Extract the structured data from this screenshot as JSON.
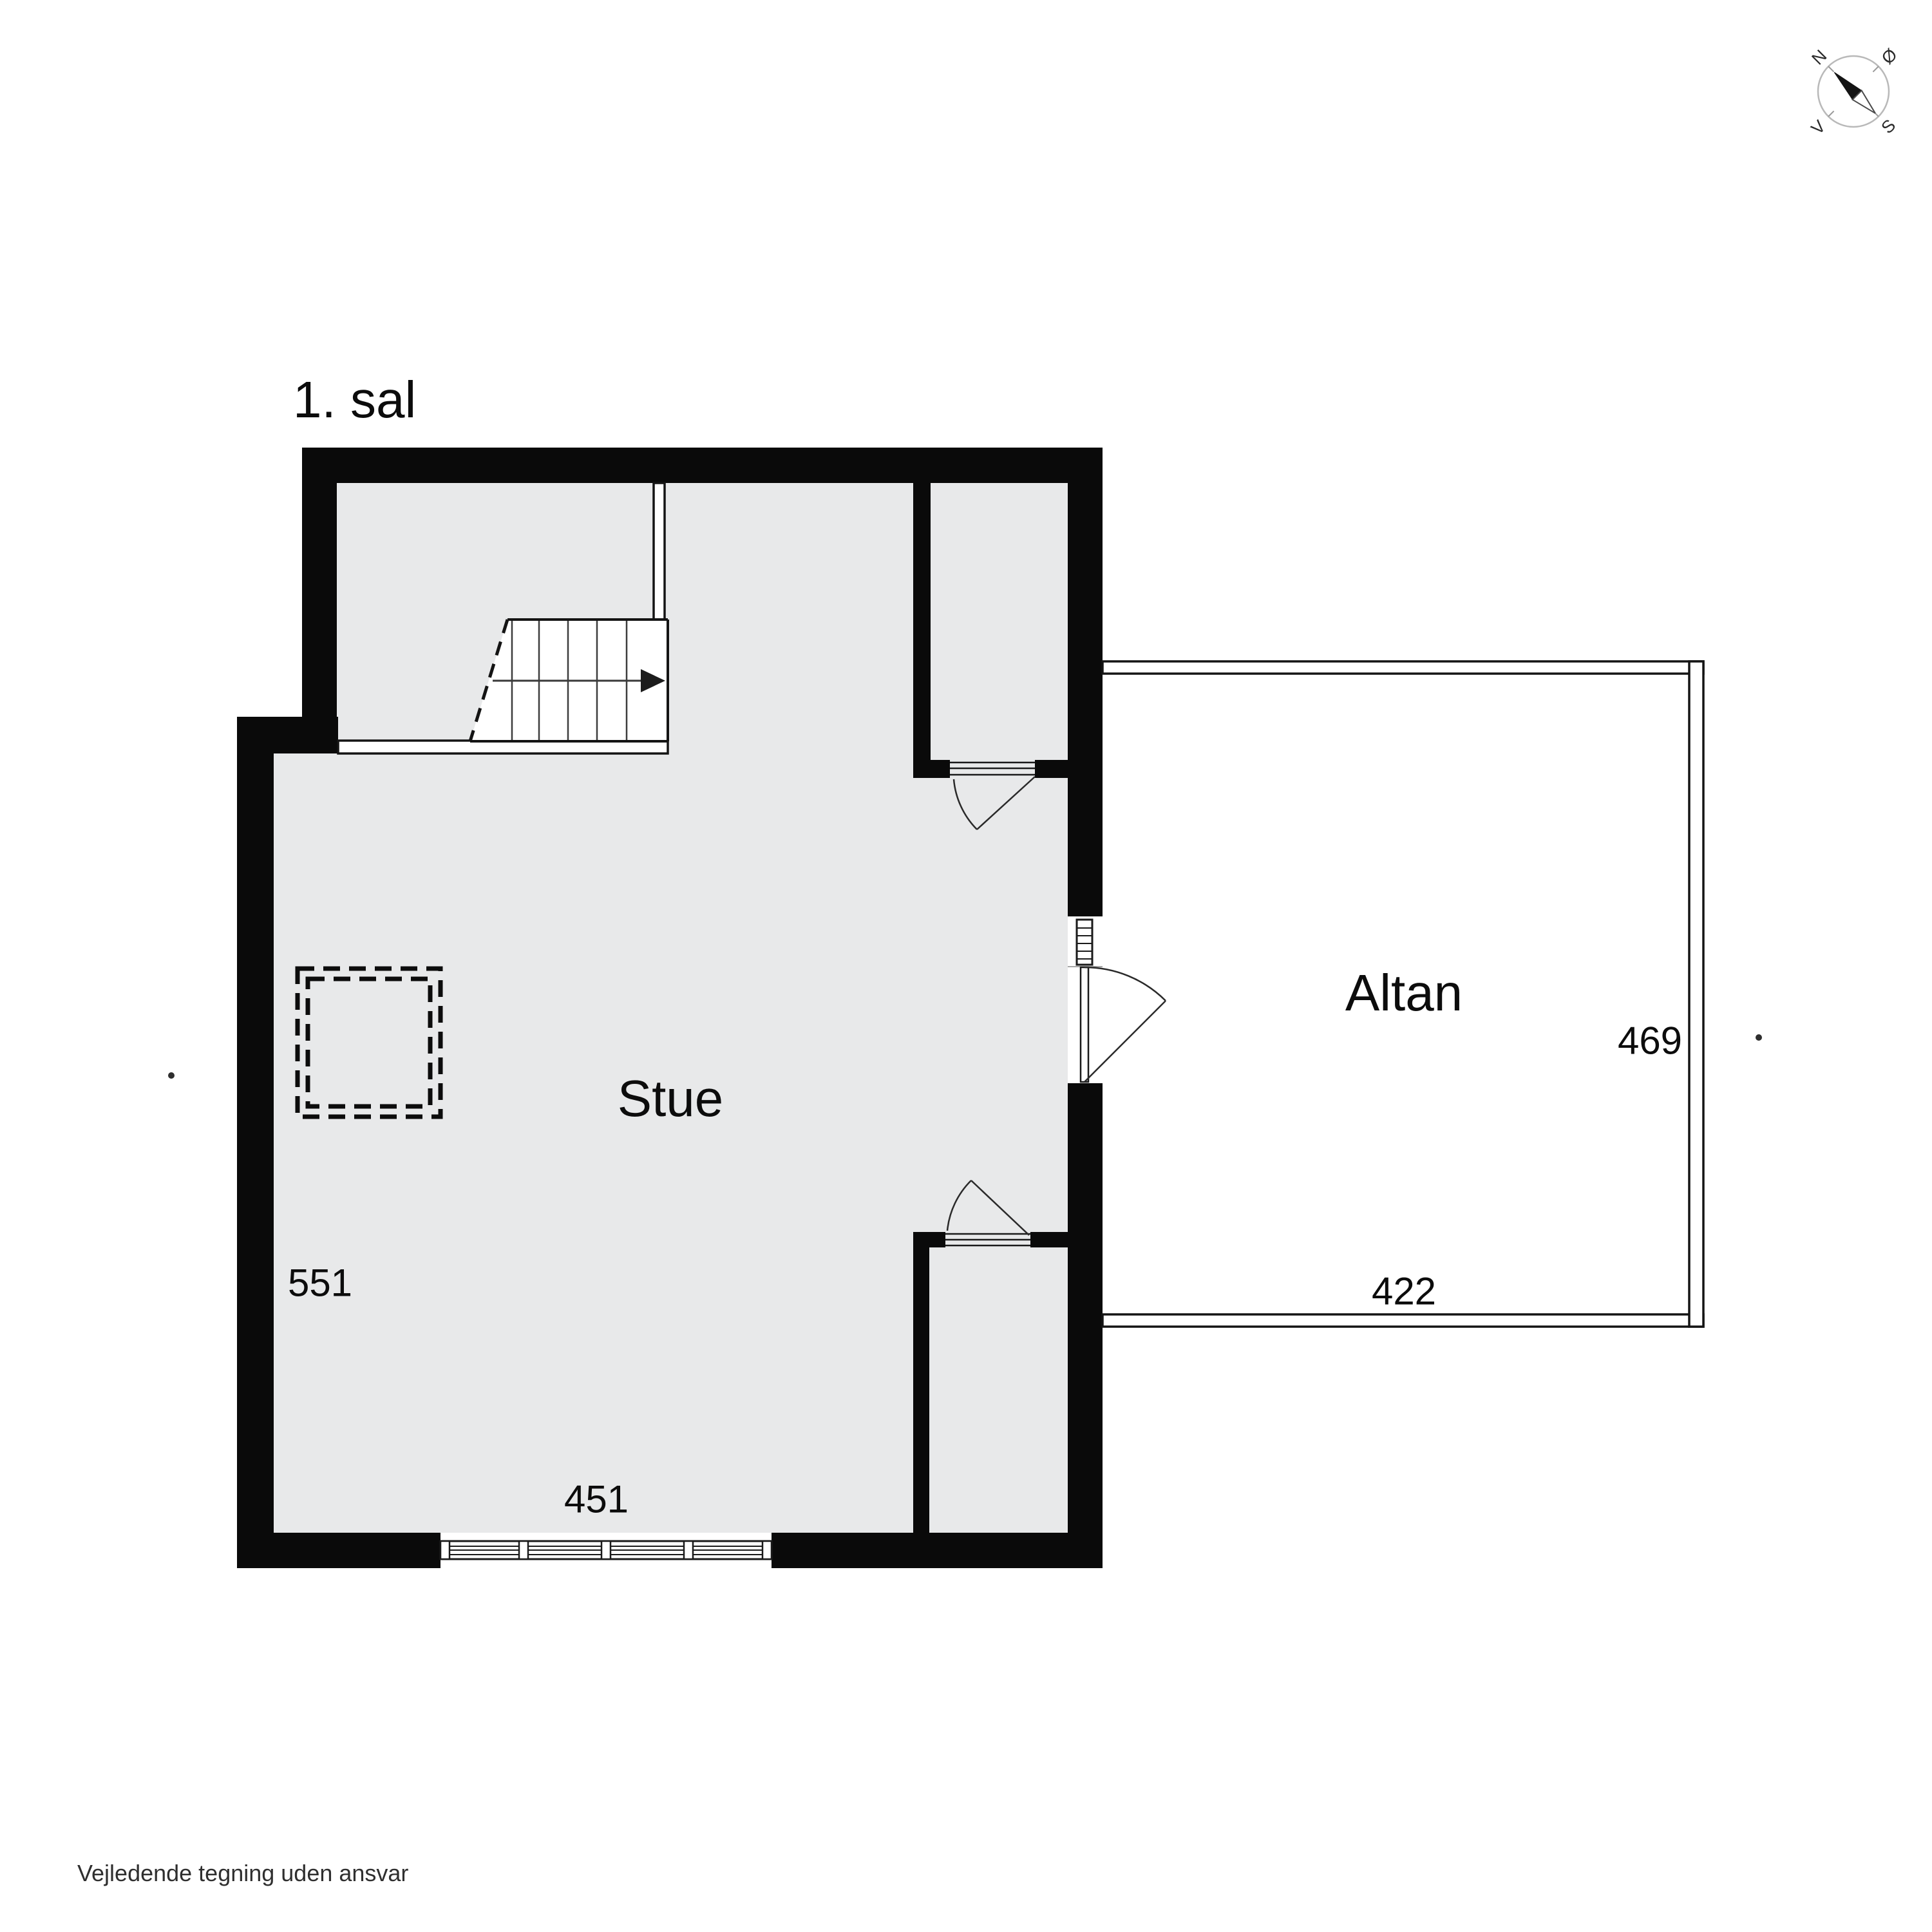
{
  "title": "1. sal",
  "rooms": {
    "stue": {
      "label": "Stue"
    },
    "altan": {
      "label": "Altan"
    }
  },
  "dimensions": {
    "stue_width": "451",
    "stue_depth": "551",
    "altan_width": "422",
    "altan_depth": "469"
  },
  "compass": {
    "north": "N",
    "east": "Ø",
    "south": "S",
    "west": "V"
  },
  "footer": {
    "disclaimer": "Vejledende tegning uden ansvar"
  },
  "colors": {
    "bg": "#ffffff",
    "wall": "#0a0a0a",
    "floor": "#e8e9ea",
    "outline": "#141414"
  }
}
